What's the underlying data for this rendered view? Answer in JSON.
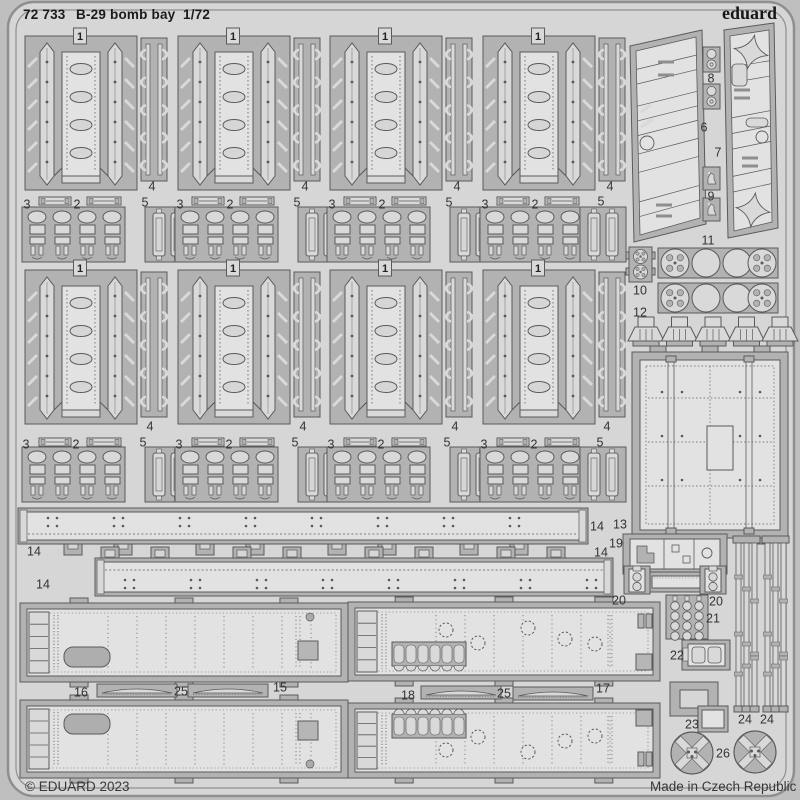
{
  "header": {
    "catalog_number": "72 733",
    "title": "B-29 bomb bay",
    "scale": "1/72",
    "brand": "eduard"
  },
  "footer": {
    "copyright": "© EDUARD 2023",
    "origin": "Made in Czech Republic"
  },
  "colors": {
    "background": "#bfbfbf",
    "sheet": "#d6d6d6",
    "part": "#b2b2b2",
    "part_light": "#d9d9d9",
    "part_bright": "#e2e2e2",
    "accent_dark": "#8e8e8e",
    "outline": "#5a5a5a",
    "frame": "#8f8f8f",
    "text": "#2b2b2b"
  },
  "part_tags": [
    {
      "text": "1",
      "x": 80,
      "y": 36
    },
    {
      "text": "1",
      "x": 233,
      "y": 36
    },
    {
      "text": "1",
      "x": 385,
      "y": 36
    },
    {
      "text": "1",
      "x": 538,
      "y": 36
    },
    {
      "text": "1",
      "x": 80,
      "y": 268
    },
    {
      "text": "1",
      "x": 233,
      "y": 268
    },
    {
      "text": "1",
      "x": 385,
      "y": 268
    },
    {
      "text": "1",
      "x": 538,
      "y": 268
    }
  ],
  "part_labels": [
    {
      "text": "4",
      "x": 152,
      "y": 186
    },
    {
      "text": "4",
      "x": 305,
      "y": 186
    },
    {
      "text": "4",
      "x": 457,
      "y": 186
    },
    {
      "text": "4",
      "x": 610,
      "y": 186
    },
    {
      "text": "3",
      "x": 27,
      "y": 204
    },
    {
      "text": "3",
      "x": 180,
      "y": 204
    },
    {
      "text": "3",
      "x": 332,
      "y": 204
    },
    {
      "text": "3",
      "x": 485,
      "y": 204
    },
    {
      "text": "2",
      "x": 77,
      "y": 204
    },
    {
      "text": "2",
      "x": 230,
      "y": 204
    },
    {
      "text": "2",
      "x": 382,
      "y": 204
    },
    {
      "text": "2",
      "x": 535,
      "y": 204
    },
    {
      "text": "5",
      "x": 145,
      "y": 202
    },
    {
      "text": "5",
      "x": 297,
      "y": 202
    },
    {
      "text": "5",
      "x": 449,
      "y": 202
    },
    {
      "text": "5",
      "x": 601,
      "y": 201
    },
    {
      "text": "4",
      "x": 150,
      "y": 426
    },
    {
      "text": "4",
      "x": 303,
      "y": 426
    },
    {
      "text": "4",
      "x": 455,
      "y": 426
    },
    {
      "text": "4",
      "x": 607,
      "y": 426
    },
    {
      "text": "3",
      "x": 26,
      "y": 444
    },
    {
      "text": "3",
      "x": 179,
      "y": 444
    },
    {
      "text": "3",
      "x": 331,
      "y": 444
    },
    {
      "text": "3",
      "x": 484,
      "y": 444
    },
    {
      "text": "2",
      "x": 76,
      "y": 444
    },
    {
      "text": "2",
      "x": 229,
      "y": 444
    },
    {
      "text": "2",
      "x": 381,
      "y": 444
    },
    {
      "text": "2",
      "x": 534,
      "y": 444
    },
    {
      "text": "5",
      "x": 143,
      "y": 442
    },
    {
      "text": "5",
      "x": 295,
      "y": 442
    },
    {
      "text": "5",
      "x": 447,
      "y": 442
    },
    {
      "text": "5",
      "x": 600,
      "y": 442
    },
    {
      "text": "8",
      "x": 711,
      "y": 78
    },
    {
      "text": "6",
      "x": 704,
      "y": 127
    },
    {
      "text": "7",
      "x": 718,
      "y": 152
    },
    {
      "text": "9",
      "x": 711,
      "y": 196
    },
    {
      "text": "11",
      "x": 708,
      "y": 240
    },
    {
      "text": "10",
      "x": 640,
      "y": 290
    },
    {
      "text": "12",
      "x": 640,
      "y": 312
    },
    {
      "text": "13",
      "x": 620,
      "y": 524
    },
    {
      "text": "14",
      "x": 34,
      "y": 551
    },
    {
      "text": "14",
      "x": 597,
      "y": 526
    },
    {
      "text": "14",
      "x": 43,
      "y": 584
    },
    {
      "text": "14",
      "x": 601,
      "y": 552
    },
    {
      "text": "19",
      "x": 616,
      "y": 543
    },
    {
      "text": "20",
      "x": 619,
      "y": 600
    },
    {
      "text": "20",
      "x": 716,
      "y": 601
    },
    {
      "text": "21",
      "x": 713,
      "y": 618
    },
    {
      "text": "22",
      "x": 677,
      "y": 655
    },
    {
      "text": "23",
      "x": 692,
      "y": 724
    },
    {
      "text": "24",
      "x": 745,
      "y": 719
    },
    {
      "text": "24",
      "x": 767,
      "y": 719
    },
    {
      "text": "26",
      "x": 723,
      "y": 753
    },
    {
      "text": "16",
      "x": 81,
      "y": 692
    },
    {
      "text": "25",
      "x": 181,
      "y": 691
    },
    {
      "text": "15",
      "x": 280,
      "y": 687
    },
    {
      "text": "18",
      "x": 408,
      "y": 695
    },
    {
      "text": "25",
      "x": 504,
      "y": 693
    },
    {
      "text": "17",
      "x": 603,
      "y": 688
    }
  ]
}
